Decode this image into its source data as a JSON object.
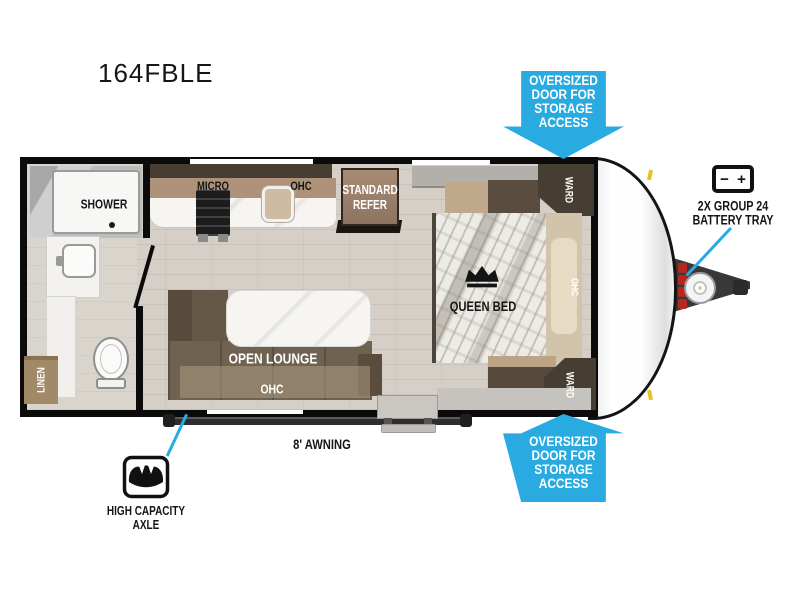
{
  "title": "164FBLE",
  "colors": {
    "arrow_blue": "#29ABE2",
    "callout_line": "#29ABE2"
  },
  "arrows": {
    "top": {
      "l1": "OVERSIZED",
      "l2": "DOOR FOR",
      "l3": "STORAGE",
      "l4": "ACCESS"
    },
    "bottom": {
      "l1": "OVERSIZED",
      "l2": "DOOR FOR",
      "l3": "STORAGE",
      "l4": "ACCESS"
    }
  },
  "callouts": {
    "battery": {
      "l1": "2X GROUP 24",
      "l2": "BATTERY TRAY",
      "minus": "−",
      "plus": "+"
    },
    "axle": {
      "l1": "HIGH CAPACITY",
      "l2": "AXLE"
    },
    "awning": {
      "label": "8' AWNING"
    }
  },
  "rooms": {
    "shower": "SHOWER",
    "linen": "LINEN",
    "micro": "MICRO",
    "kitchen_ohc": "OHC",
    "refer_l1": "STANDARD",
    "refer_l2": "REFER",
    "ward_top": "WARD",
    "bed_ohc": "OHC",
    "ward_bottom": "WARD",
    "queen_bed": "QUEEN BED",
    "open_lounge": "OPEN LOUNGE",
    "lounge_ohc": "OHC"
  },
  "icons": {
    "battery": "battery-icon",
    "axle": "scale-icon",
    "crown": "crown-icon",
    "propane": "propane-tank-icon"
  }
}
